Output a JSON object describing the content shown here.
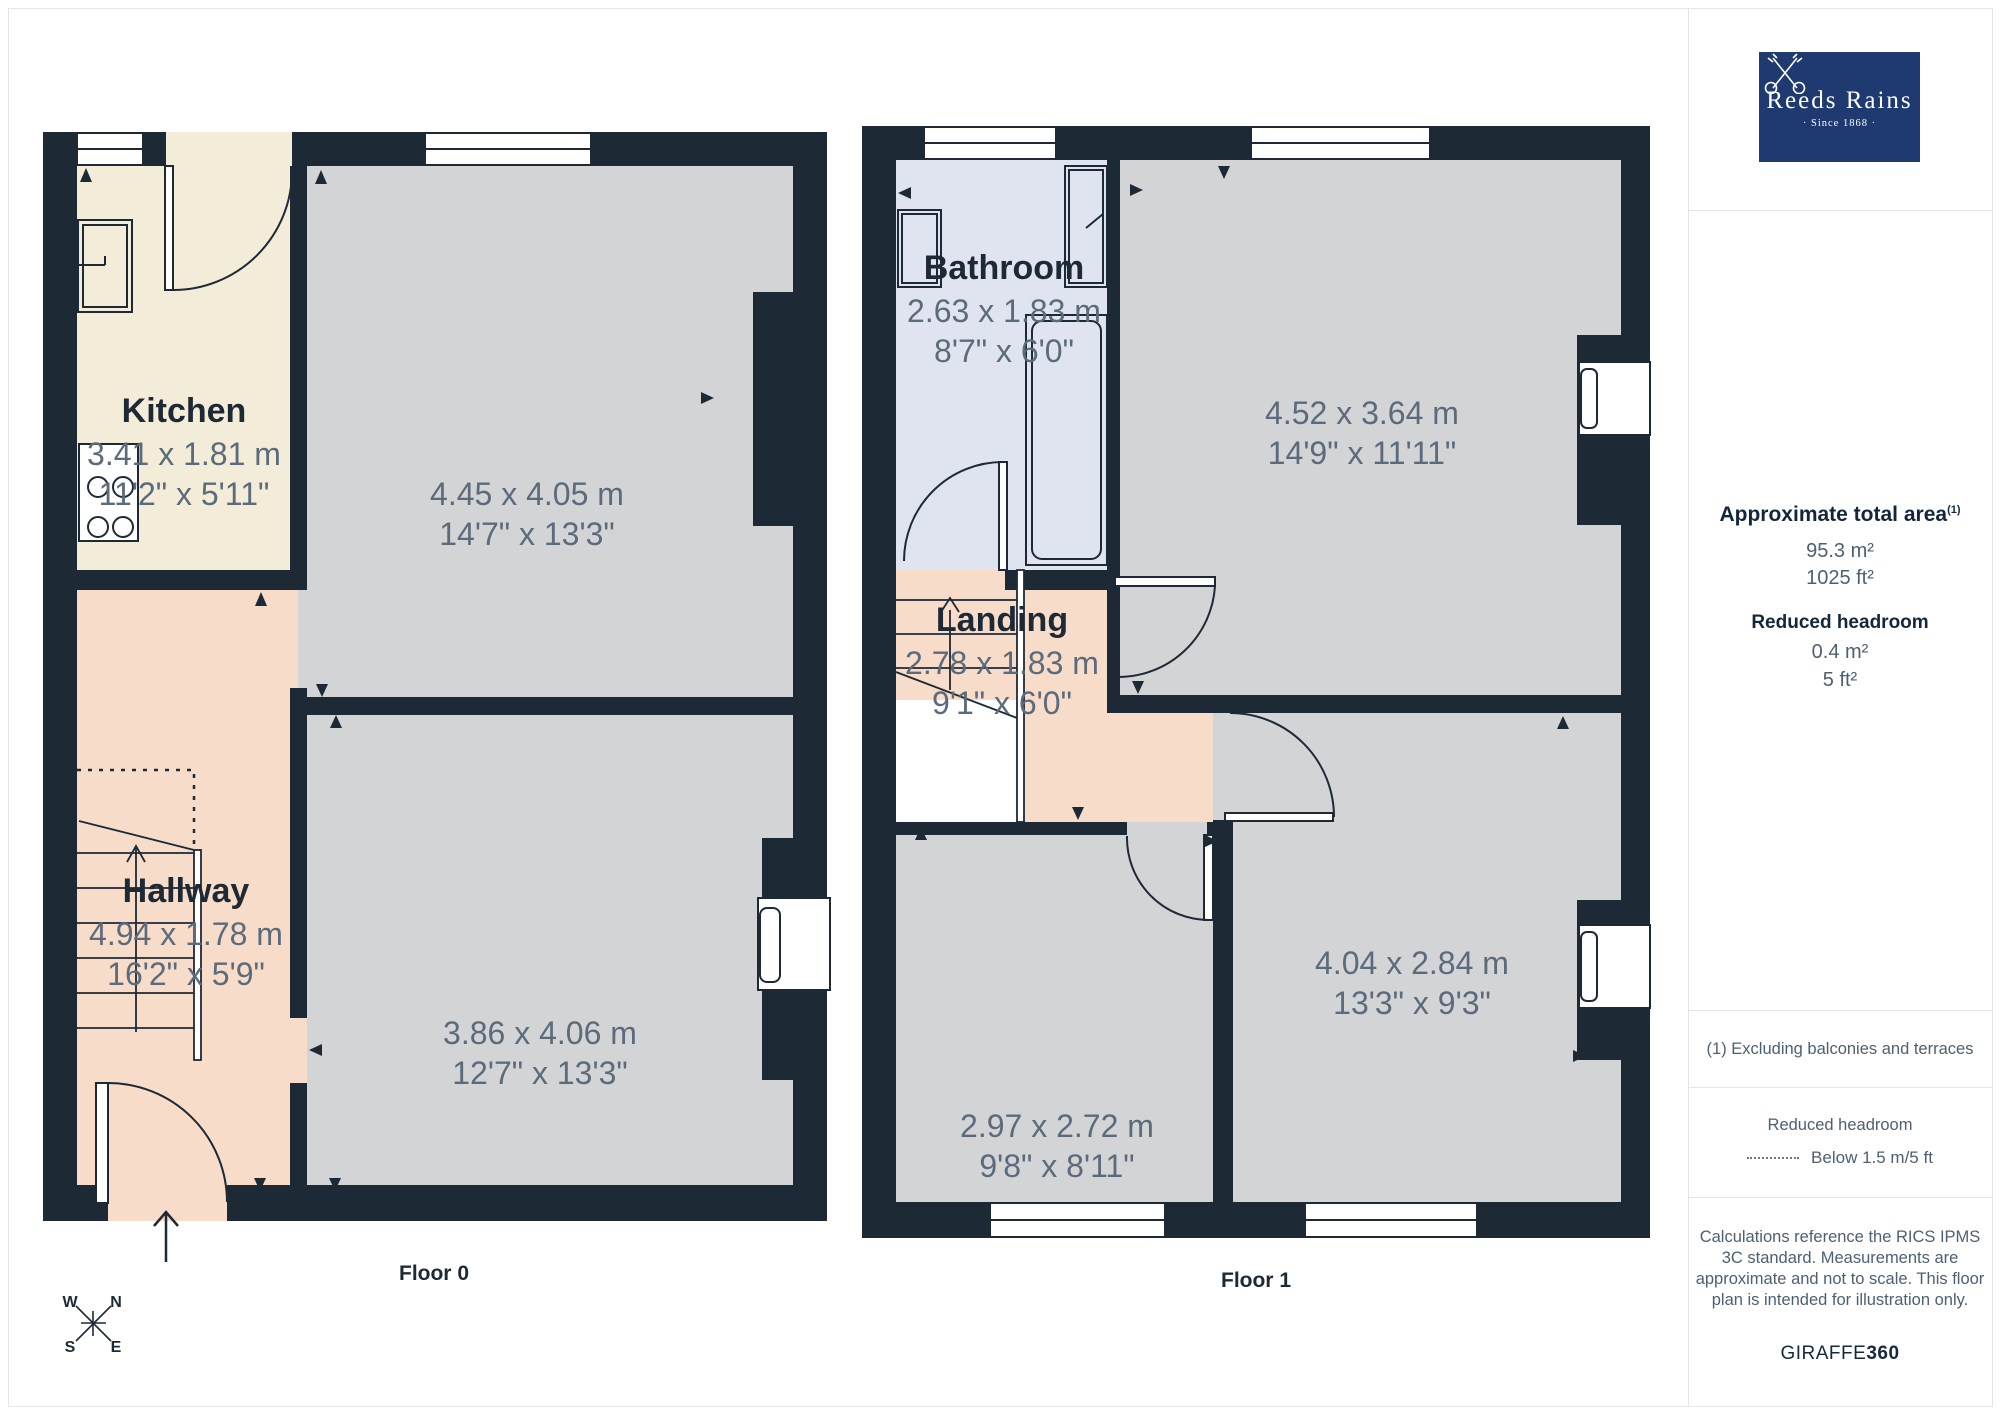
{
  "colors": {
    "wall": "#1e2936",
    "room_gray": "#d3d4d6",
    "kitchen_cream": "#f3ecd9",
    "hall_salmon": "#f6dcc9",
    "bath_blue": "#e0e4f0",
    "dim_text": "#5c6b7b",
    "logo_navy": "#1e3a70"
  },
  "brand": {
    "name": "Reeds Rains",
    "tagline": "· Since 1868 ·"
  },
  "sidebar": {
    "area_title": "Approximate total area",
    "area_footnote_marker": "(1)",
    "area_m2": "95.3 m²",
    "area_ft2": "1025 ft²",
    "rh_title": "Reduced headroom",
    "rh_m2": "0.4 m²",
    "rh_ft2": "5 ft²",
    "footnote": "(1) Excluding balconies and terraces",
    "legend_title": "Reduced headroom",
    "legend_label": "Below 1.5 m/5 ft",
    "disclaimer": "Calculations reference the RICS IPMS 3C standard. Measurements are approximate and not to scale. This floor plan is intended for illustration only.",
    "credit_normal": "GIRAFFE",
    "credit_bold": "360"
  },
  "floor0": {
    "label": "Floor 0",
    "kitchen": {
      "name": "Kitchen",
      "metric": "3.41 x 1.81 m",
      "imperial": "11'2\" x 5'11\""
    },
    "reception1": {
      "metric": "4.45 x 4.05 m",
      "imperial": "14'7\" x 13'3\""
    },
    "hallway": {
      "name": "Hallway",
      "metric": "4.94 x 1.78 m",
      "imperial": "16'2\" x 5'9\""
    },
    "reception2": {
      "metric": "3.86 x 4.06 m",
      "imperial": "12'7\" x 13'3\""
    }
  },
  "floor1": {
    "label": "Floor 1",
    "bathroom": {
      "name": "Bathroom",
      "metric": "2.63 x 1.83 m",
      "imperial": "8'7\" x 6'0\""
    },
    "bedroom1": {
      "metric": "4.52 x 3.64 m",
      "imperial": "14'9\" x 11'11\""
    },
    "landing": {
      "name": "Landing",
      "metric": "2.78 x 1.83 m",
      "imperial": "9'1\" x 6'0\""
    },
    "bedroom2": {
      "metric": "2.97 x 2.72 m",
      "imperial": "9'8\" x 8'11\""
    },
    "bedroom3": {
      "metric": "4.04 x 2.84 m",
      "imperial": "13'3\" x 9'3\""
    }
  },
  "compass": {
    "n": "N",
    "e": "E",
    "s": "S",
    "w": "W"
  }
}
